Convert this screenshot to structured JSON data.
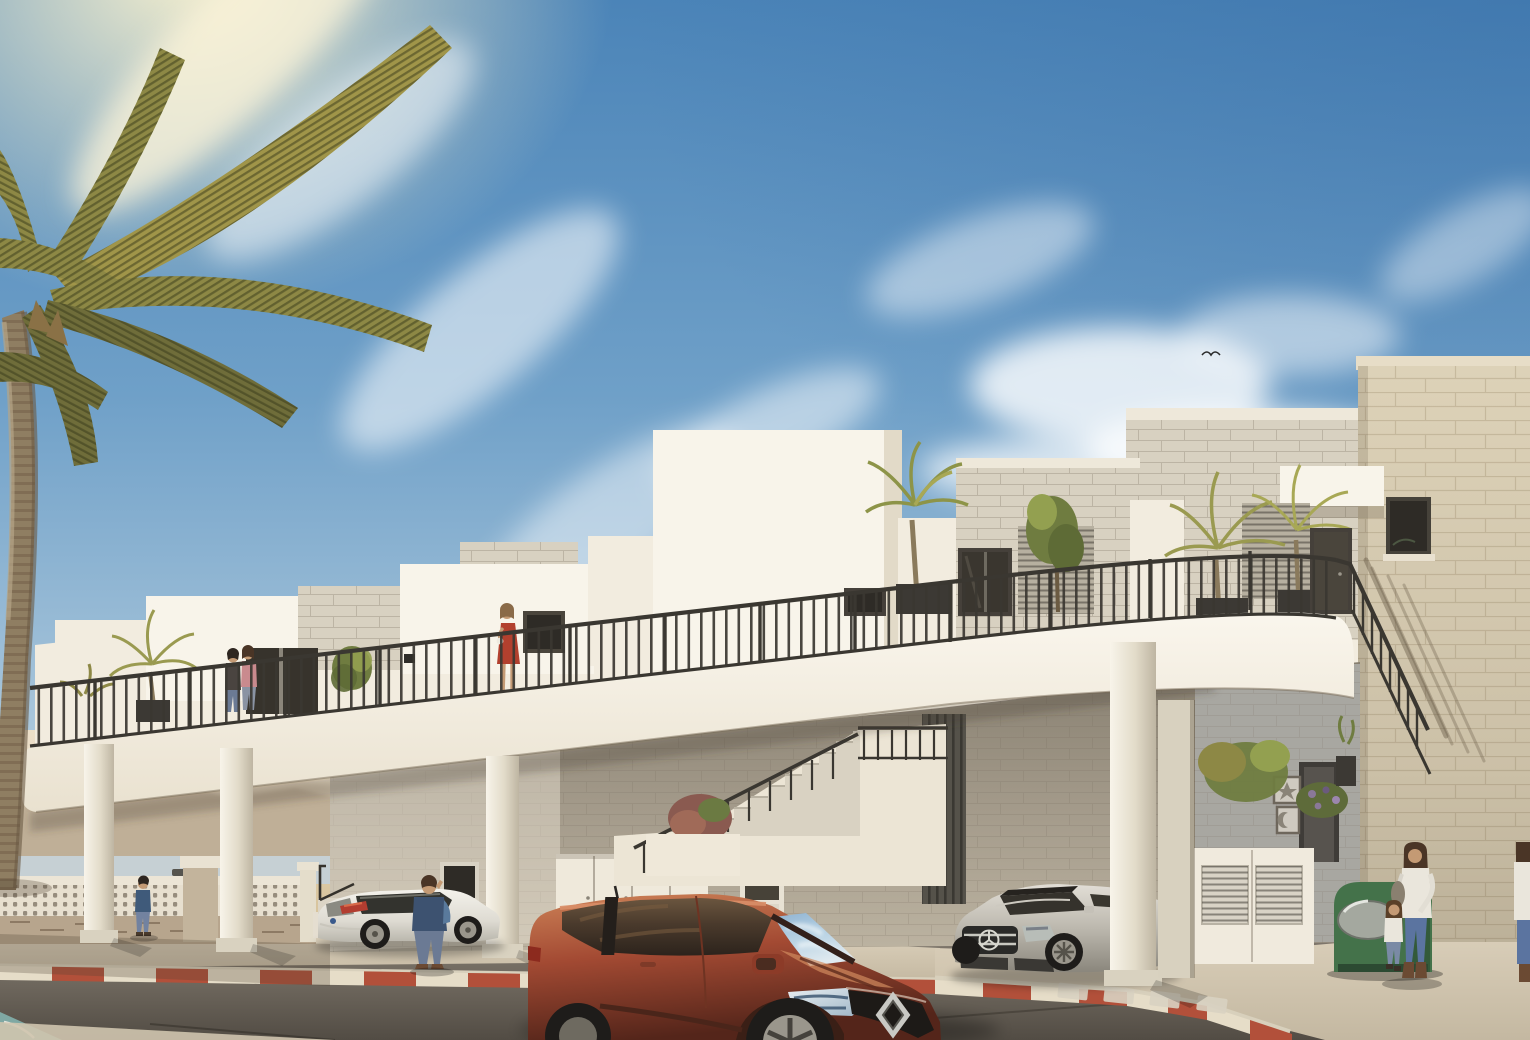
{
  "scene": {
    "type": "architectural exterior rendering",
    "setting": "modern white two-storey apartment block with long first-floor terrace, seaside street corner, sunny day",
    "sky": "blue sky with wispy clouds, sun glow upper-left, one small bird",
    "background_left": "hazy mountains, sea with a small ship, sandy beach behind a stone fence with perforated breeze blocks",
    "building_features": [
      "stepped white roof parapets",
      "stone-block penthouse volumes",
      "tall white stair tower",
      "continuous balcony with black vertical-bar railing, rounded ends",
      "potted palms and planters on terrace",
      "louvered privacy screens",
      "dark aluminium windows and doors",
      "round white columns under slab",
      "exterior staircase with black railing",
      "white storage-unit doors",
      "beige stone right wing with railing shadow",
      "entrance patio with door, two framed pictures (starfish, shell), plants and white louvered gate"
    ],
    "vehicles": [
      {
        "name": "red-hatchback",
        "color": "rust red",
        "badge": "diamond badge",
        "position": "foreground center"
      },
      {
        "name": "white-hatchback",
        "color": "white",
        "badge": "blue oval badge",
        "position": "parked left under colonnade"
      },
      {
        "name": "silver-sedan",
        "color": "silver",
        "badge": "three-pointed-star badge",
        "position": "parked right behind column"
      }
    ],
    "people": [
      {
        "name": "couple-on-terrace",
        "where": "left end of balcony"
      },
      {
        "name": "woman-red-dress",
        "where": "balcony center-left, holding white cup"
      },
      {
        "name": "distant-man",
        "where": "far left sidewalk"
      },
      {
        "name": "man-on-phone",
        "where": "left sidewalk, blue shirt"
      },
      {
        "name": "woman-with-child",
        "where": "right sidewalk near green container"
      },
      {
        "name": "edge-figure",
        "where": "partially cut at right edge"
      }
    ],
    "street": "asphalt road, red-and-white striped curbs, white crossing dashes, pale sidewalks, green recycling container"
  },
  "palette": {
    "skyTop": "#4b84b8",
    "skyMid": "#6fa0c8",
    "skyLow": "#a6c4da",
    "skyHorizon": "#d9e2e2",
    "sunGlow": "#fdf4cf",
    "cloud": "#ffffff",
    "warmCloud": "#fff6da",
    "hazeTop": "#ecdfc8",
    "hazeLow": "#e0d4bc",
    "mountain": "#b3a28a",
    "sea": "#c6d0d4",
    "sand": "#dbc8a2",
    "ship": "#56544e",
    "wallWhite": "#f2ecdf",
    "wallBright": "#f8f4ea",
    "wallShade": "#e2dac8",
    "fasciaTop": "#faf6ed",
    "fasciaBot": "#e9e1cf",
    "stoneLight": "#d8d1c1",
    "stoneCap": "#eee8da",
    "wingStone": "#ddd2b8",
    "wingCap": "#e7ddc7",
    "gfTop": "#877f70",
    "gfMid": "#a39a8a",
    "gfBot": "#bcb3a1",
    "patioWall": "#a8a7a1",
    "railing": "#3a3731",
    "glassDark": "#2e2b26",
    "doorDark": "#4a453c",
    "louverFace": "#b7b0a0",
    "leafLight": "#a09549",
    "leafMid": "#8d8845",
    "leafDark": "#6f6d3a",
    "leafStripe": "rgba(55,57,26,.5)",
    "trunkLight": "#b5a587",
    "trunkMid": "#8f7e62",
    "trunkDark": "#6a5a44",
    "planter": "#3c3934",
    "foliage": "#6f7c40",
    "foliageHi": "#93a050",
    "bushRed": "#8a5a50",
    "bushRedHi": "#a06a58",
    "walkLight": "#dbd0bb",
    "walkDark": "#c4b8a1",
    "curbRed": "#b2503a",
    "curbWhite": "#e6ddc8",
    "roadTop": "#837b70",
    "roadMid": "#6e675d",
    "roadBot": "#524c44",
    "zebra": "#d9d2c2",
    "tealArt": "#7fa8a3",
    "carRedHi": "#cd8257",
    "carRed": "#a34a33",
    "carRedDark": "#54251a",
    "glassBlue": "#8fb3d2",
    "glassBlueMid": "#b9d3e4",
    "glassBlueLight": "#dfe9ef",
    "sideGlassHi": "#6b563f",
    "sideGlassMid": "#4a3a2c",
    "sideGlassLo": "#2c231c",
    "silverHi": "#e2ded6",
    "silverMid": "#bcb8ae",
    "silverLo": "#8a867c",
    "whiteCarHi": "#f4f2ec",
    "whiteCarMid": "#dedbd2",
    "whiteCarLo": "#b9b6ac",
    "tire": "#1e1c1a",
    "alloy": "#9a968c",
    "green": "#44724a",
    "greenDark": "#335a3a",
    "chute": "#a4a89f",
    "skin": "#c49a74",
    "hairBrown": "#4a3526",
    "hairDark": "#2e2620",
    "navy": "#3d5270",
    "jeans": "#6b7a94",
    "jeansBlue": "#5b74a0",
    "redDress": "#b2402e",
    "pinkTop": "#c98a8e",
    "whiteCloth": "#eae6dc",
    "boots": "#6b4a33",
    "blockLine": "rgba(115,105,88,.28)",
    "wingLine": "rgba(150,130,100,.30)",
    "holeColor": "rgba(70,58,44,.5)",
    "shadowSoft": "rgba(70,58,45,.28)",
    "shadowHard": "rgba(0,0,0,.25)",
    "railShadow": "rgba(95,82,62,.30)"
  }
}
